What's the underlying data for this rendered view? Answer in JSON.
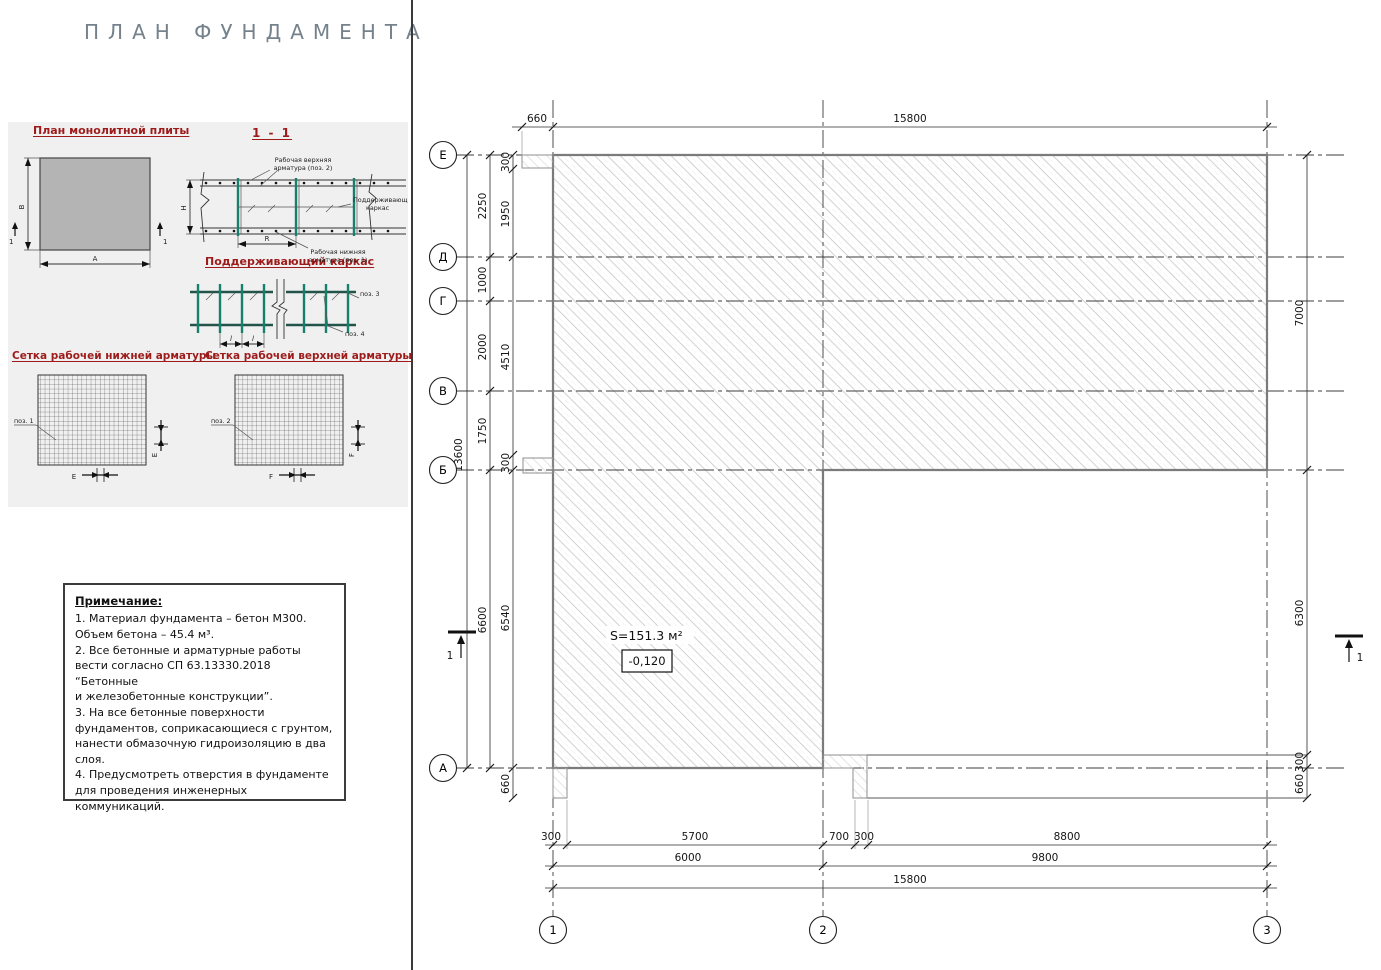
{
  "title": "ПЛАН ФУНДАМЕНТА",
  "colors": {
    "accent_red": "#9e1b1b",
    "teal": "#17806c",
    "slab_grey": "#b4b4b4",
    "title_grey": "#75828c",
    "hatch_grey": "#c6c6c6"
  },
  "panel": {
    "h_slab": "План монолитной плиты",
    "h_section": "1 - 1",
    "h_frame": "Поддерживающий каркас",
    "h_mesh_bottom": "Сетка рабочей нижней арматуры",
    "h_mesh_top": "Сетка рабочей верхней арматуры",
    "slab": {
      "a": "А",
      "b": "В",
      "mark": "1"
    },
    "section": {
      "top1": "Рабочая верхняя",
      "top2": "арматура (поз. 2)",
      "frame1": "Поддерживающий",
      "frame2": "каркас",
      "bot1": "Рабочая нижняя",
      "bot2": "арматура (поз. 1)",
      "h": "Н",
      "r": "R"
    },
    "frame": {
      "pos3": "поз. 3",
      "pos4": "поз. 4",
      "l": "l"
    },
    "mesh_bottom": {
      "pos": "поз. 1",
      "e": "E"
    },
    "mesh_top": {
      "pos": "поз. 2",
      "f": "F"
    }
  },
  "notes": {
    "heading": "Примечание:",
    "items": [
      "1. Материал фундамента – бетон М300.\nОбъем бетона –  45.4 м³.",
      "2. Все бетонные и арматурные работы\nвести согласно СП 63.13330.2018 “Бетонные\nи железобетонные конструкции”.",
      "3. На все бетонные поверхности\nфундаментов, соприкасающиеся с грунтом,\nнанести обмазочную гидроизоляцию в два\nслоя.",
      "4. Предусмотреть отверстия в фундаменте\nдля проведения инженерных коммуникаций."
    ]
  },
  "plan": {
    "area_label": "S=151.3 м²",
    "elevation": "-0,120",
    "section_label": "1",
    "axes_rows": [
      "Е",
      "Д",
      "Г",
      "В",
      "Б",
      "А"
    ],
    "axes_cols": [
      "1",
      "2",
      "3"
    ],
    "dims": {
      "top_660": "660",
      "top_15800": "15800",
      "total_13600": "13600",
      "l2250": "2250",
      "l1000": "1000",
      "l2000": "2000",
      "l1750": "1750",
      "l6600": "6600",
      "i300a": "300",
      "i1950": "1950",
      "i4510": "4510",
      "i300b": "300",
      "i6540": "6540",
      "i660": "660",
      "r7000": "7000",
      "r6300": "6300",
      "r300": "300",
      "r660": "660",
      "b300a": "300",
      "b5700": "5700",
      "b700": "700",
      "b300b": "300",
      "b8800": "8800",
      "b6000": "6000",
      "b9800": "9800",
      "b15800": "15800"
    }
  }
}
